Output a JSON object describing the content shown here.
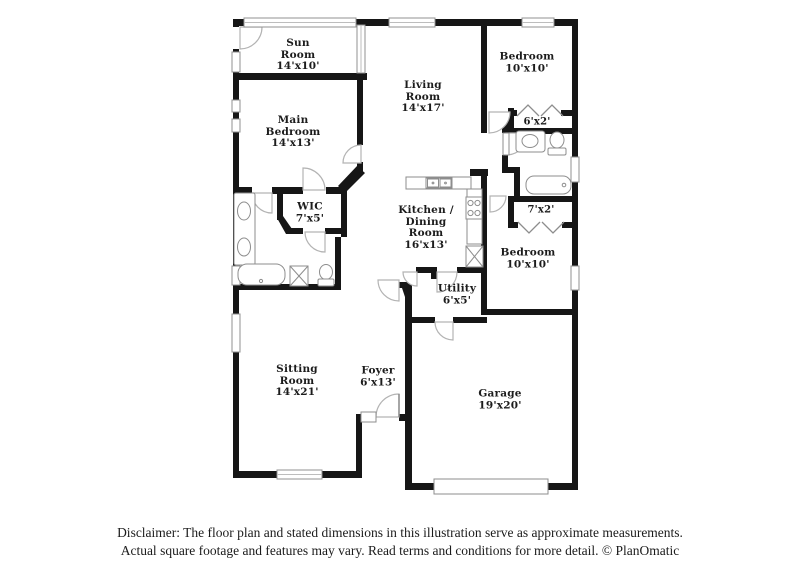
{
  "title": "Floor plan illustration",
  "colors": {
    "wall": "#161616",
    "fixture_stroke": "#8d8d8d",
    "window_stroke": "#909090",
    "door_arc": "#b3b3b3",
    "background": "#ffffff"
  },
  "rooms": [
    {
      "id": "sun-room",
      "label": "Sun\nRoom\n14'x10'"
    },
    {
      "id": "living-room",
      "label": "Living\nRoom\n14'x17'"
    },
    {
      "id": "bedroom-1",
      "label": "Bedroom\n10'x10'"
    },
    {
      "id": "closet-6x2",
      "label": "6'x2'"
    },
    {
      "id": "main-bedroom",
      "label": "Main\nBedroom\n14'x13'"
    },
    {
      "id": "wic",
      "label": "WIC\n7'x5'"
    },
    {
      "id": "kitchen-dining",
      "label": "Kitchen /\nDining\nRoom\n16'x13'"
    },
    {
      "id": "closet-7x2",
      "label": "7'x2'"
    },
    {
      "id": "bedroom-2",
      "label": "Bedroom\n10'x10'"
    },
    {
      "id": "utility",
      "label": "Utility\n6'x5'"
    },
    {
      "id": "sitting-room",
      "label": "Sitting\nRoom\n14'x21'"
    },
    {
      "id": "foyer",
      "label": "Foyer\n6'x13'"
    },
    {
      "id": "garage",
      "label": "Garage\n19'x20'"
    }
  ],
  "fixtures": [
    "double-vanity-sinks",
    "bathtub",
    "shower",
    "toilet",
    "kitchen-double-sink",
    "stove",
    "pantry",
    "hall-bath-vanity",
    "hall-bath-toilet",
    "hall-bathtub",
    "garage-door",
    "front-door"
  ],
  "disclaimer": {
    "line1": "Disclaimer: The floor plan and stated dimensions in this illustration serve as approximate measurements.",
    "line2": "Actual square footage and features may vary. Read terms and conditions for more detail. © PlanOmatic"
  }
}
